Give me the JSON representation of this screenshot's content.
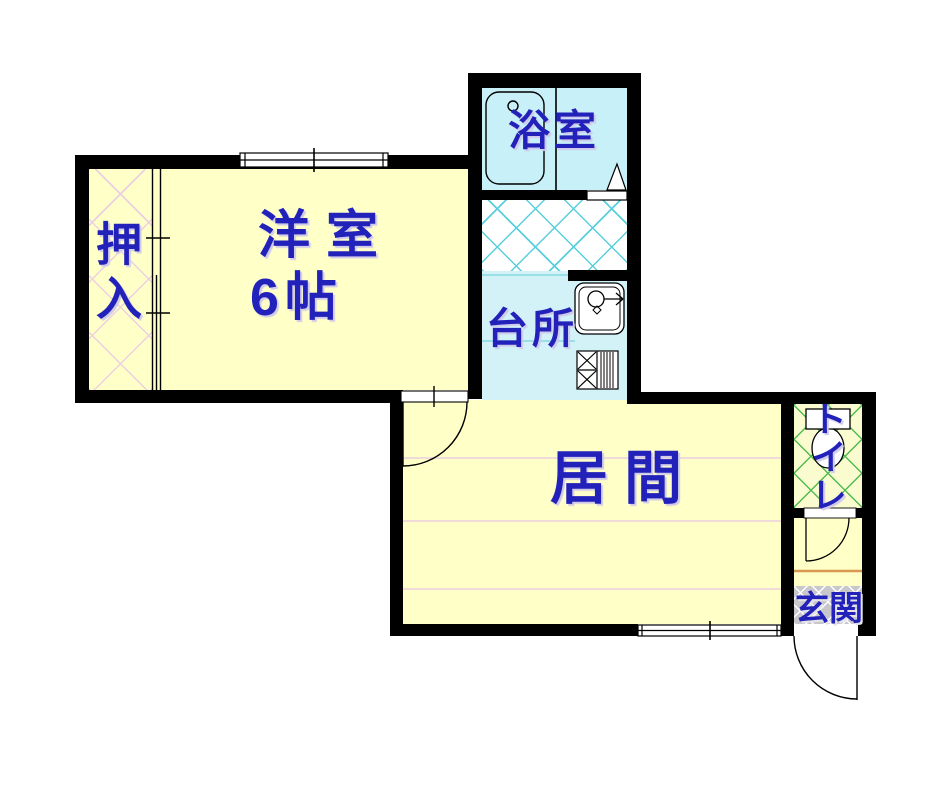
{
  "rooms": {
    "bathroom": {
      "label": "浴室"
    },
    "kitchen": {
      "label": "台所"
    },
    "western_room": {
      "label": "洋室",
      "size": "6帖"
    },
    "closet": {
      "label": "押入"
    },
    "living_room": {
      "label": "居間"
    },
    "toilet": {
      "label": "トイレ"
    },
    "entrance": {
      "label": "玄関"
    }
  },
  "icons": {
    "bathtub": "bathtub-icon",
    "kitchen_sink": "kitchen-sink-icon",
    "gas_stove": "gas-stove-icon",
    "toilet_bowl": "toilet-bowl-icon",
    "door_swing": "door-swing-arc",
    "window": "window-symbol",
    "sliding_door": "sliding-door-symbol",
    "bath_door": "bath-door-triangle"
  },
  "colors": {
    "wall": "#000000",
    "room_fill": "#FFFFC8",
    "bathroom_fill": "#C8F0F8",
    "kitchen_fill": "#D2F2F8",
    "label_text": "#2222BB",
    "washroom_lattice": "#58CFDC",
    "closet_lattice": "#EDCFE4",
    "toilet_lattice": "#4FBE50",
    "entrance_fill": "#C8C8CC",
    "entrance_step_line": "#D89850"
  }
}
